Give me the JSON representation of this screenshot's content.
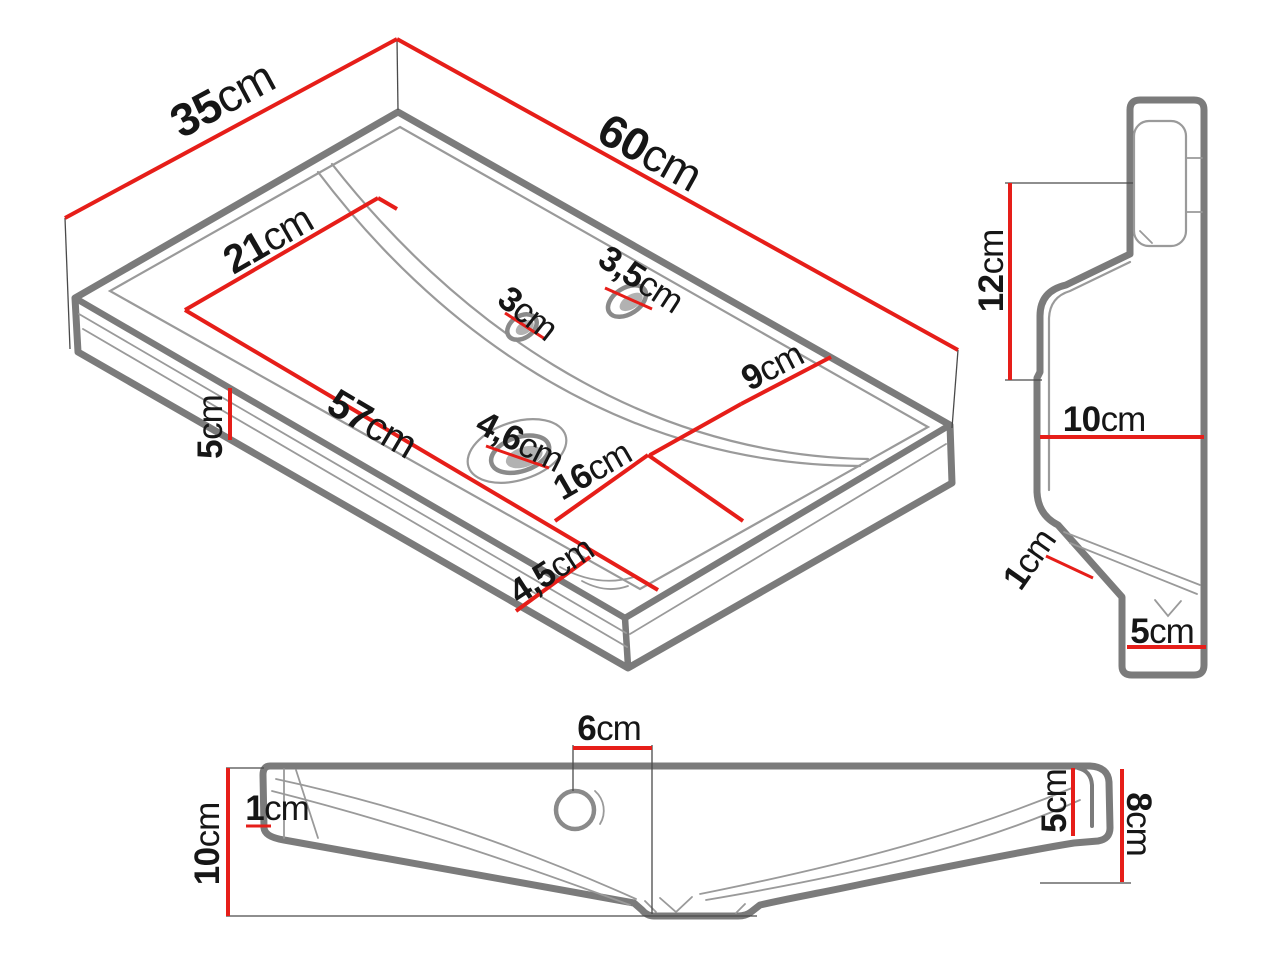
{
  "colors": {
    "accent": "#e61e19",
    "outline": "#7b7b7b",
    "ink": "#161616"
  },
  "dims": {
    "iso_depth": {
      "value": "35",
      "unit": "cm"
    },
    "iso_width": {
      "value": "60",
      "unit": "cm"
    },
    "iso_basin_depth_left": {
      "value": "21",
      "unit": "cm"
    },
    "iso_basin_length": {
      "value": "57",
      "unit": "cm"
    },
    "iso_basin_width_right": {
      "value": "16",
      "unit": "cm"
    },
    "iso_deck_right": {
      "value": "9",
      "unit": "cm"
    },
    "iso_front_rim_height": {
      "value": "5",
      "unit": "cm"
    },
    "iso_drain_hole": {
      "value": "4,6",
      "unit": "cm"
    },
    "iso_front_edge": {
      "value": "4,5",
      "unit": "cm"
    },
    "iso_overflow_hole": {
      "value": "3",
      "unit": "cm"
    },
    "iso_faucet_hole": {
      "value": "3,5",
      "unit": "cm"
    },
    "side_back_height": {
      "value": "12",
      "unit": "cm"
    },
    "side_depth": {
      "value": "10",
      "unit": "cm"
    },
    "side_channel": {
      "value": "1",
      "unit": "cm"
    },
    "side_bottom_depth": {
      "value": "5",
      "unit": "cm"
    },
    "front_faucet_offset": {
      "value": "6",
      "unit": "cm"
    },
    "front_rim_thickness": {
      "value": "1",
      "unit": "cm"
    },
    "front_height": {
      "value": "10",
      "unit": "cm"
    },
    "front_right_recess": {
      "value": "5",
      "unit": "cm"
    },
    "front_right_height": {
      "value": "8",
      "unit": "cm"
    }
  }
}
